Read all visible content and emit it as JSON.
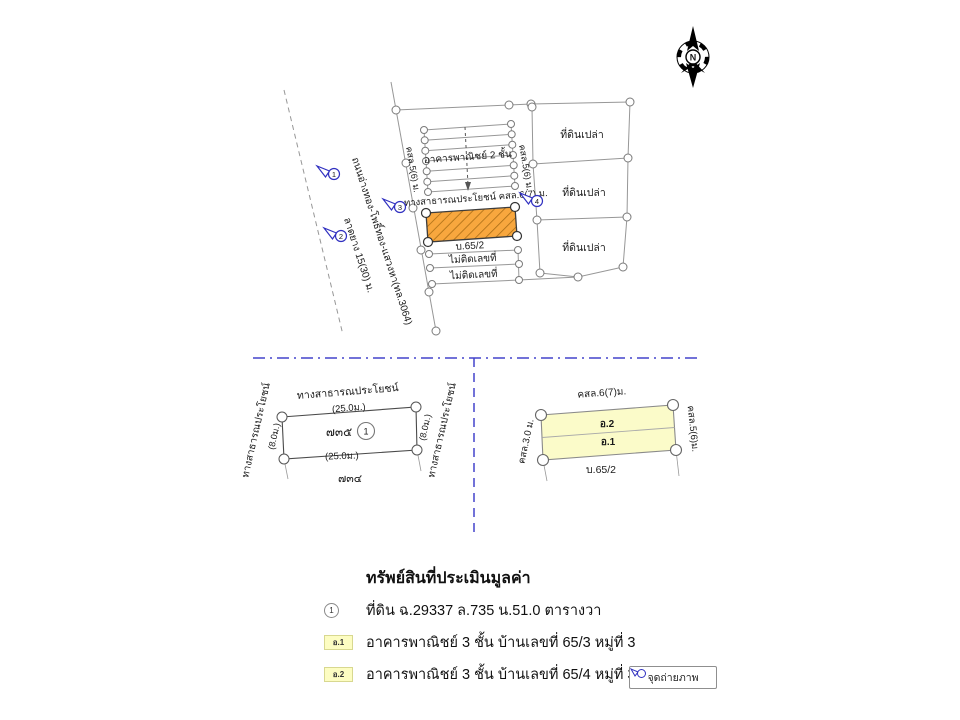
{
  "compass": {
    "north_label": "N"
  },
  "site_map": {
    "road_name": "ถนนอ่างทอง-โพธิ์ทอง-แสวงหา(ทล.3064)",
    "road_surface": "ลาดยาง 15(30) ม.",
    "markers": {
      "m1": "1",
      "m2": "2",
      "m3": "3",
      "m4": "4"
    },
    "building_label": "อาคารพาณิชย์ 2 ชั้น",
    "lane_left": "คสล.5(6) ม.",
    "lane_right": "คสล.5(6) ม.",
    "public_way": "ทางสาธารณประโยชน์ คสล.6(7) ม.",
    "subject_label": "บ.65/2",
    "strip1": "ไม่ติดเลขที่",
    "strip2": "ไม่ติดเลขที่",
    "vacant1": "ที่ดินเปล่า",
    "vacant2": "ที่ดินเปล่า",
    "vacant3": "ที่ดินเปล่า"
  },
  "left_plot": {
    "top_label": "ทางสาธารณประโยชน์",
    "top_dim": "(25.0ม.)",
    "bottom_dim": "(25.0ม.)",
    "left_label": "ทางสาธารณประโยชน์",
    "left_dim": "(8.0ม.)",
    "right_label": "ทางสาธารณประโยชน์",
    "right_dim": "(8.0ม.)",
    "parcel_no": "๗๓๕",
    "marker": "1",
    "below_parcel_no": "๗๓๔"
  },
  "right_plot": {
    "top_label": "คสล.6(7)ม.",
    "left_label": "คสล.3.0 ม.",
    "right_label": "คสล.5(6)ม.",
    "bottom_label": "บ.65/2",
    "upper_unit": "อ.2",
    "lower_unit": "อ.1"
  },
  "legend": {
    "title": "ทรัพย์สินที่ประเมินมูลค่า",
    "items": [
      {
        "badge": "1",
        "text": "ที่ดิน ฉ.29337 ล.735 น.51.0 ตารางวา"
      },
      {
        "badge": "อ.1",
        "text": "อาคารพาณิชย์ 3  ชั้น บ้านเลขที่ 65/3 หมู่ที่ 3"
      },
      {
        "badge": "อ.2",
        "text": "อาคารพาณิชย์ 3  ชั้น บ้านเลขที่ 65/4 หมู่ที่ 3"
      }
    ]
  },
  "photo_button": {
    "label": "จุดถ่ายภาพ"
  },
  "colors": {
    "blue_annotation": "#2a2ab8",
    "marker_blue": "#3030c0",
    "divider_blue": "#4343cb",
    "orange_fill": "#f8a73e",
    "orange_hatch": "#aa6d15",
    "yellow_fill": "#fbfbc9",
    "map_line_gray": "#979797"
  }
}
